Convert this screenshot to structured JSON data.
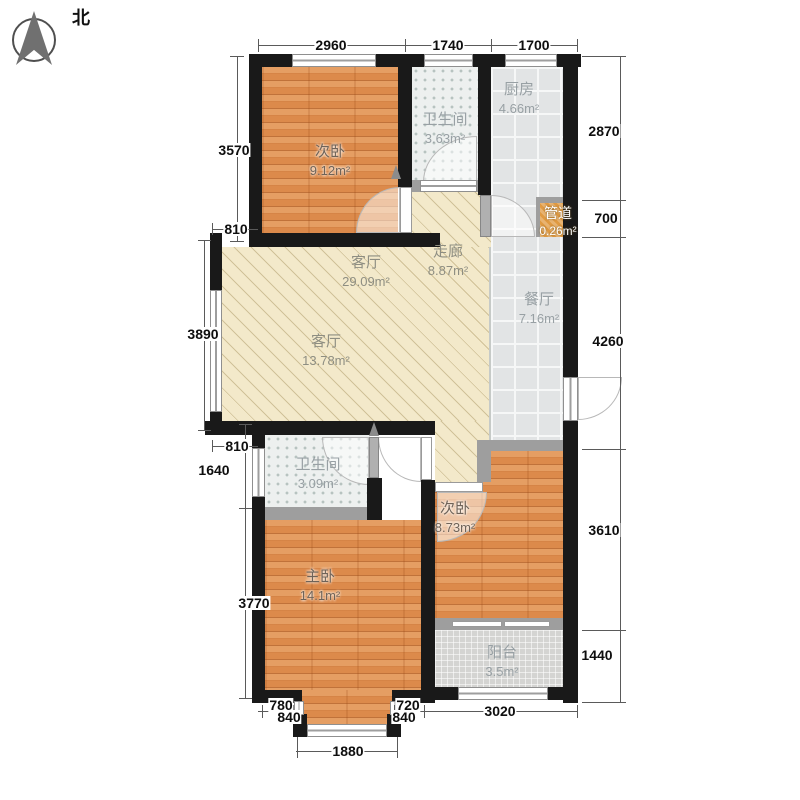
{
  "compass": {
    "north_label": "北"
  },
  "rooms": {
    "bedroom_top": {
      "name": "次卧",
      "area": "9.12m²"
    },
    "bath_top": {
      "name": "卫生间",
      "area": "3.63m²"
    },
    "kitchen": {
      "name": "厨房",
      "area": "4.66m²"
    },
    "duct": {
      "name": "管道",
      "area": "0.26m²"
    },
    "corridor": {
      "name": "走廊",
      "area": "8.87m²"
    },
    "living_upper": {
      "name": "客厅",
      "area": "29.09m²"
    },
    "living_lower": {
      "name": "客厅",
      "area": "13.78m²"
    },
    "dining": {
      "name": "餐厅",
      "area": "7.16m²"
    },
    "bath_lower": {
      "name": "卫生间",
      "area": "3.09m²"
    },
    "bedroom_right": {
      "name": "次卧",
      "area": "8.73m²"
    },
    "master": {
      "name": "主卧",
      "area": "14.1m²"
    },
    "balcony": {
      "name": "阳台",
      "area": "3.5m²"
    }
  },
  "dimensions": {
    "top": [
      "2960",
      "1740",
      "1700"
    ],
    "left": [
      "3570",
      "810",
      "3890",
      "810",
      "1640",
      "3770"
    ],
    "right": [
      "2870",
      "700",
      "4260",
      "3610",
      "1440"
    ],
    "bottom": [
      "780",
      "840",
      "720",
      "840",
      "1880",
      "3020"
    ]
  },
  "colors": {
    "wall": "#191919",
    "wood_floor": "#dc8a4b",
    "living_floor": "#f3e9ca",
    "bath_floor": "#edf0ef",
    "tile_floor": "#e2e4e5",
    "balcony_floor": "#d4d4d2",
    "duct_fill": "#e09a42"
  }
}
